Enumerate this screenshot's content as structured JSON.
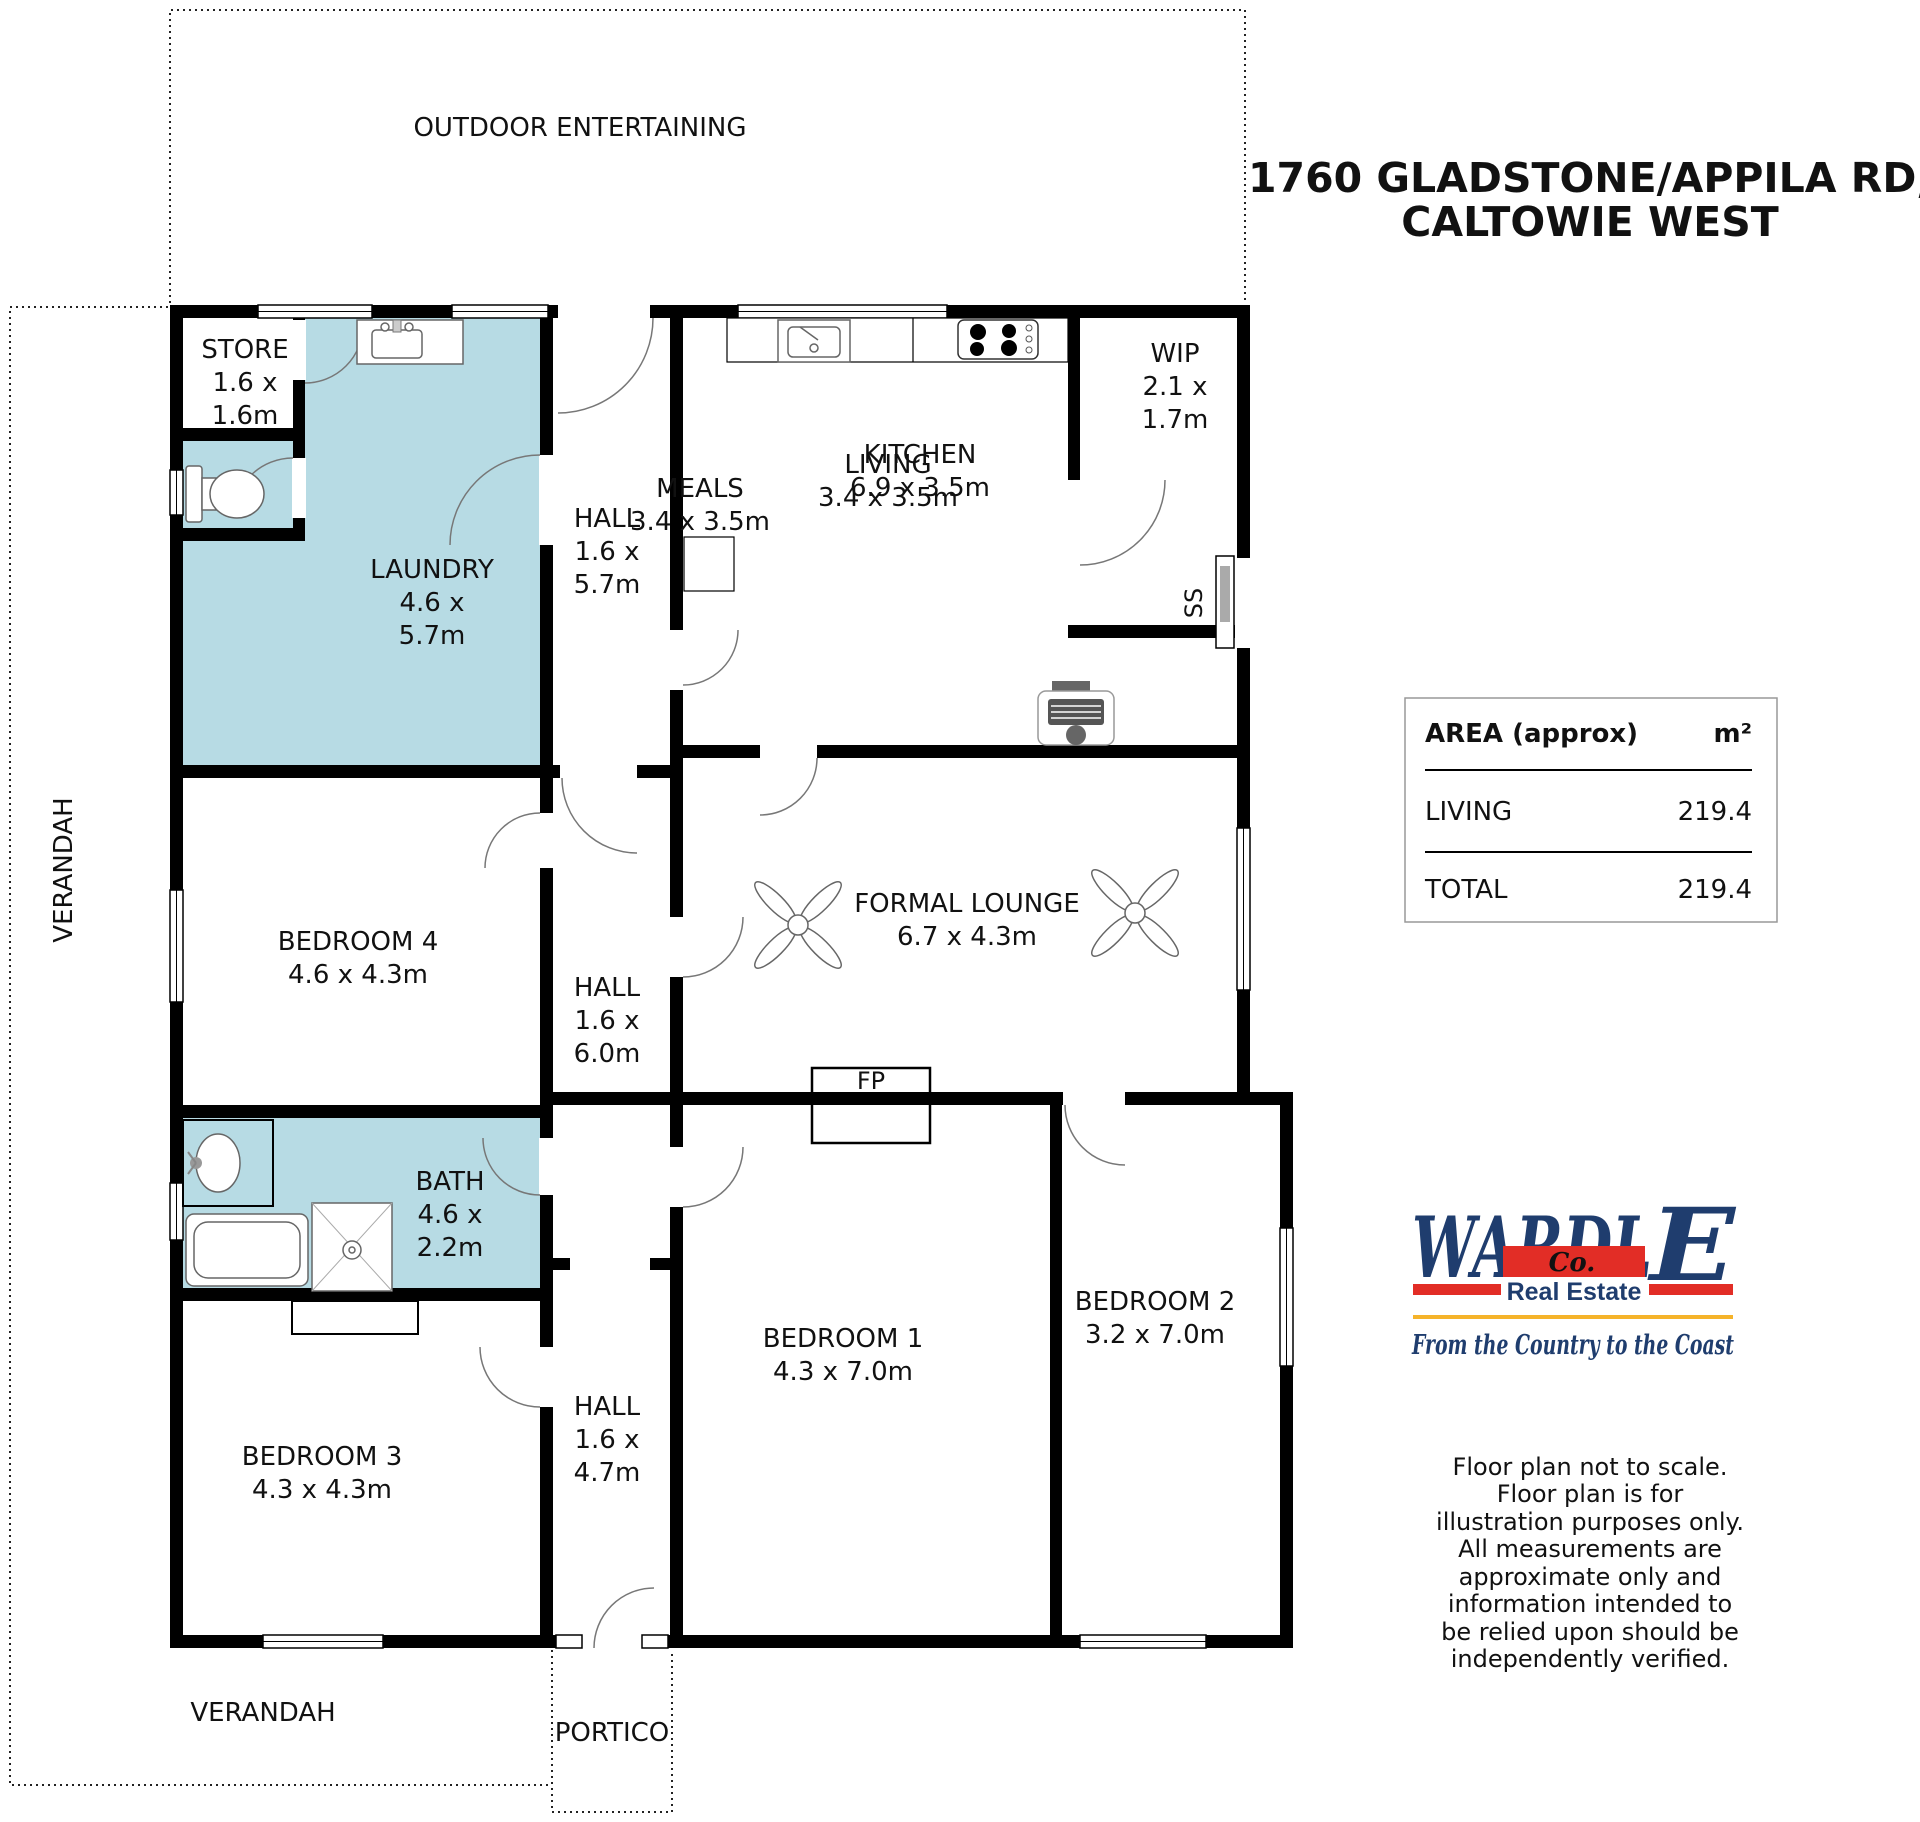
{
  "title": {
    "line1": "1760 GLADSTONE/APPILA RD,",
    "line2": "CALTOWIE WEST"
  },
  "plan": {
    "outdoor_label": "OUTDOOR ENTERTAINING",
    "verandah_side_label": "VERANDAH",
    "verandah_bottom_label": "VERANDAH",
    "portico_label": "PORTICO",
    "fireplace_label": "FP",
    "sliding_door_label": "SS",
    "rooms": {
      "store": [
        "STORE",
        "1.6 x",
        "1.6m"
      ],
      "laundry": [
        "LAUNDRY",
        "4.6 x",
        "5.7m"
      ],
      "hall_top": [
        "HALL",
        "1.6 x",
        "5.7m"
      ],
      "kitchen": [
        "KITCHEN",
        "6.9 x 3.5m"
      ],
      "wip": [
        "WIP",
        "2.1 x",
        "1.7m"
      ],
      "meals": [
        "MEALS",
        "3.4 x 3.5m"
      ],
      "living": [
        "LIVING",
        "3.4 x 3.5m"
      ],
      "bedroom4": [
        "BEDROOM 4",
        "4.6 x 4.3m"
      ],
      "hall_mid": [
        "HALL",
        "1.6 x",
        "6.0m"
      ],
      "formal_lounge": [
        "FORMAL LOUNGE",
        "6.7 x 4.3m"
      ],
      "bath": [
        "BATH",
        "4.6 x",
        "2.2m"
      ],
      "bedroom3": [
        "BEDROOM 3",
        "4.3 x 4.3m"
      ],
      "hall_bottom": [
        "HALL",
        "1.6 x",
        "4.7m"
      ],
      "bedroom1": [
        "BEDROOM 1",
        "4.3 x 7.0m"
      ],
      "bedroom2": [
        "BEDROOM 2",
        "3.2 x 7.0m"
      ]
    }
  },
  "area_table": {
    "header_label": "AREA (approx)",
    "header_unit": "m²",
    "rows": [
      {
        "label": "LIVING",
        "value": "219.4"
      },
      {
        "label": "TOTAL",
        "value": "219.4"
      }
    ]
  },
  "logo": {
    "brand_main": "WARDL",
    "brand_last": "E",
    "co": "Co.",
    "subtitle": "Real Estate",
    "tagline": "From the Country to the Coast"
  },
  "disclaimer": [
    "Floor plan not to scale.",
    "Floor plan is for",
    "illustration purposes only.",
    "All measurements are",
    "approximate only and",
    "information intended to",
    "be relied upon should be",
    "independently verified."
  ],
  "colors": {
    "highlight_room": "#b7dbe4",
    "wall": "#000000",
    "logo_navy": "#1f3d6e",
    "logo_red": "#e22d26",
    "logo_gold": "#f5b32a"
  }
}
